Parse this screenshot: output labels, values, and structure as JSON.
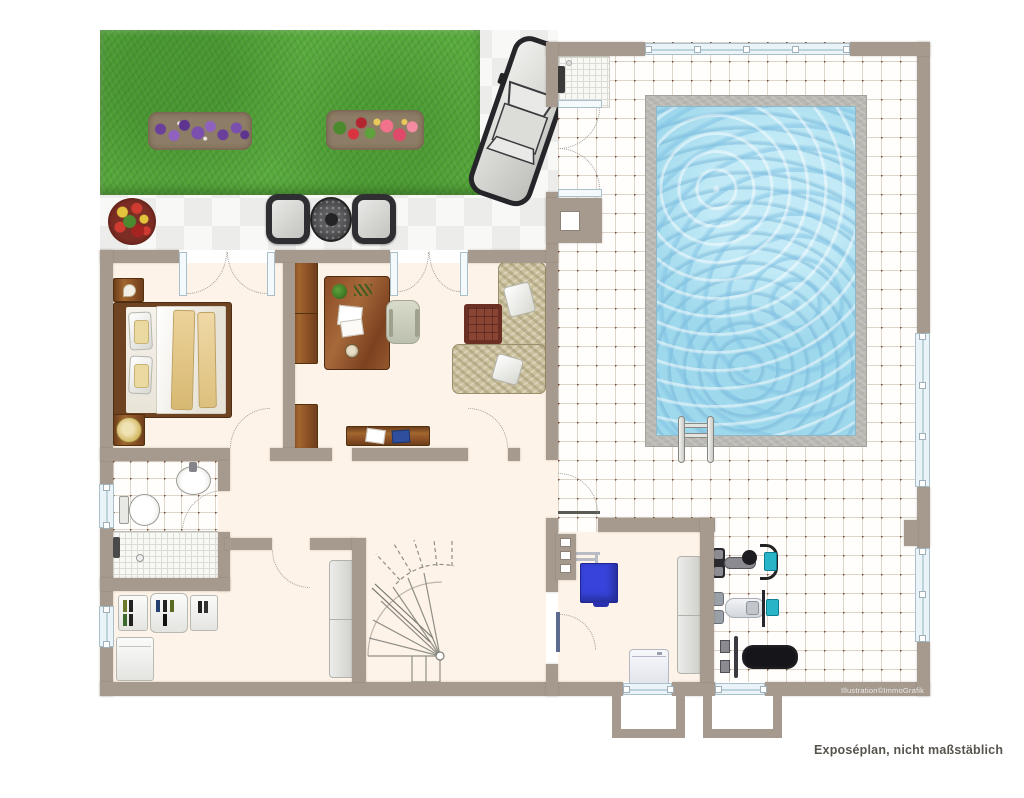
{
  "texts": {
    "caption": "Exposéplan, nicht maßstäblich",
    "watermark": "Illustration©ImmoGrafik"
  },
  "palette": {
    "wall": "#a69a8e",
    "floor": "#fdf3e8",
    "grass": "#57a93c",
    "soil": "#8d7c66",
    "water": "#9ed8ec",
    "pool_edge": "#b9b8b2",
    "tiledot": "#7a5138",
    "tileline": "#ddd4ca",
    "glass": "#eaf4f8",
    "wood": "#a2662f",
    "sofa": "#cdc29e",
    "blanket": "#e7cc8c",
    "boiler": "#3743da",
    "teal": "#29b4c8",
    "bench": "#15151a"
  },
  "features": [
    "garden",
    "flower-beds",
    "patio-terrace",
    "terrace-seating",
    "driveway-car",
    "pool-hall",
    "swimming-pool",
    "pool-ladder",
    "outdoor-shower",
    "bedroom",
    "office",
    "living-area",
    "bathroom",
    "hallway",
    "winder-staircase",
    "utility-room",
    "boiler",
    "washing-machine",
    "home-gym",
    "exercise-bike",
    "rowing-machine",
    "weight-bench",
    "light-wells"
  ]
}
